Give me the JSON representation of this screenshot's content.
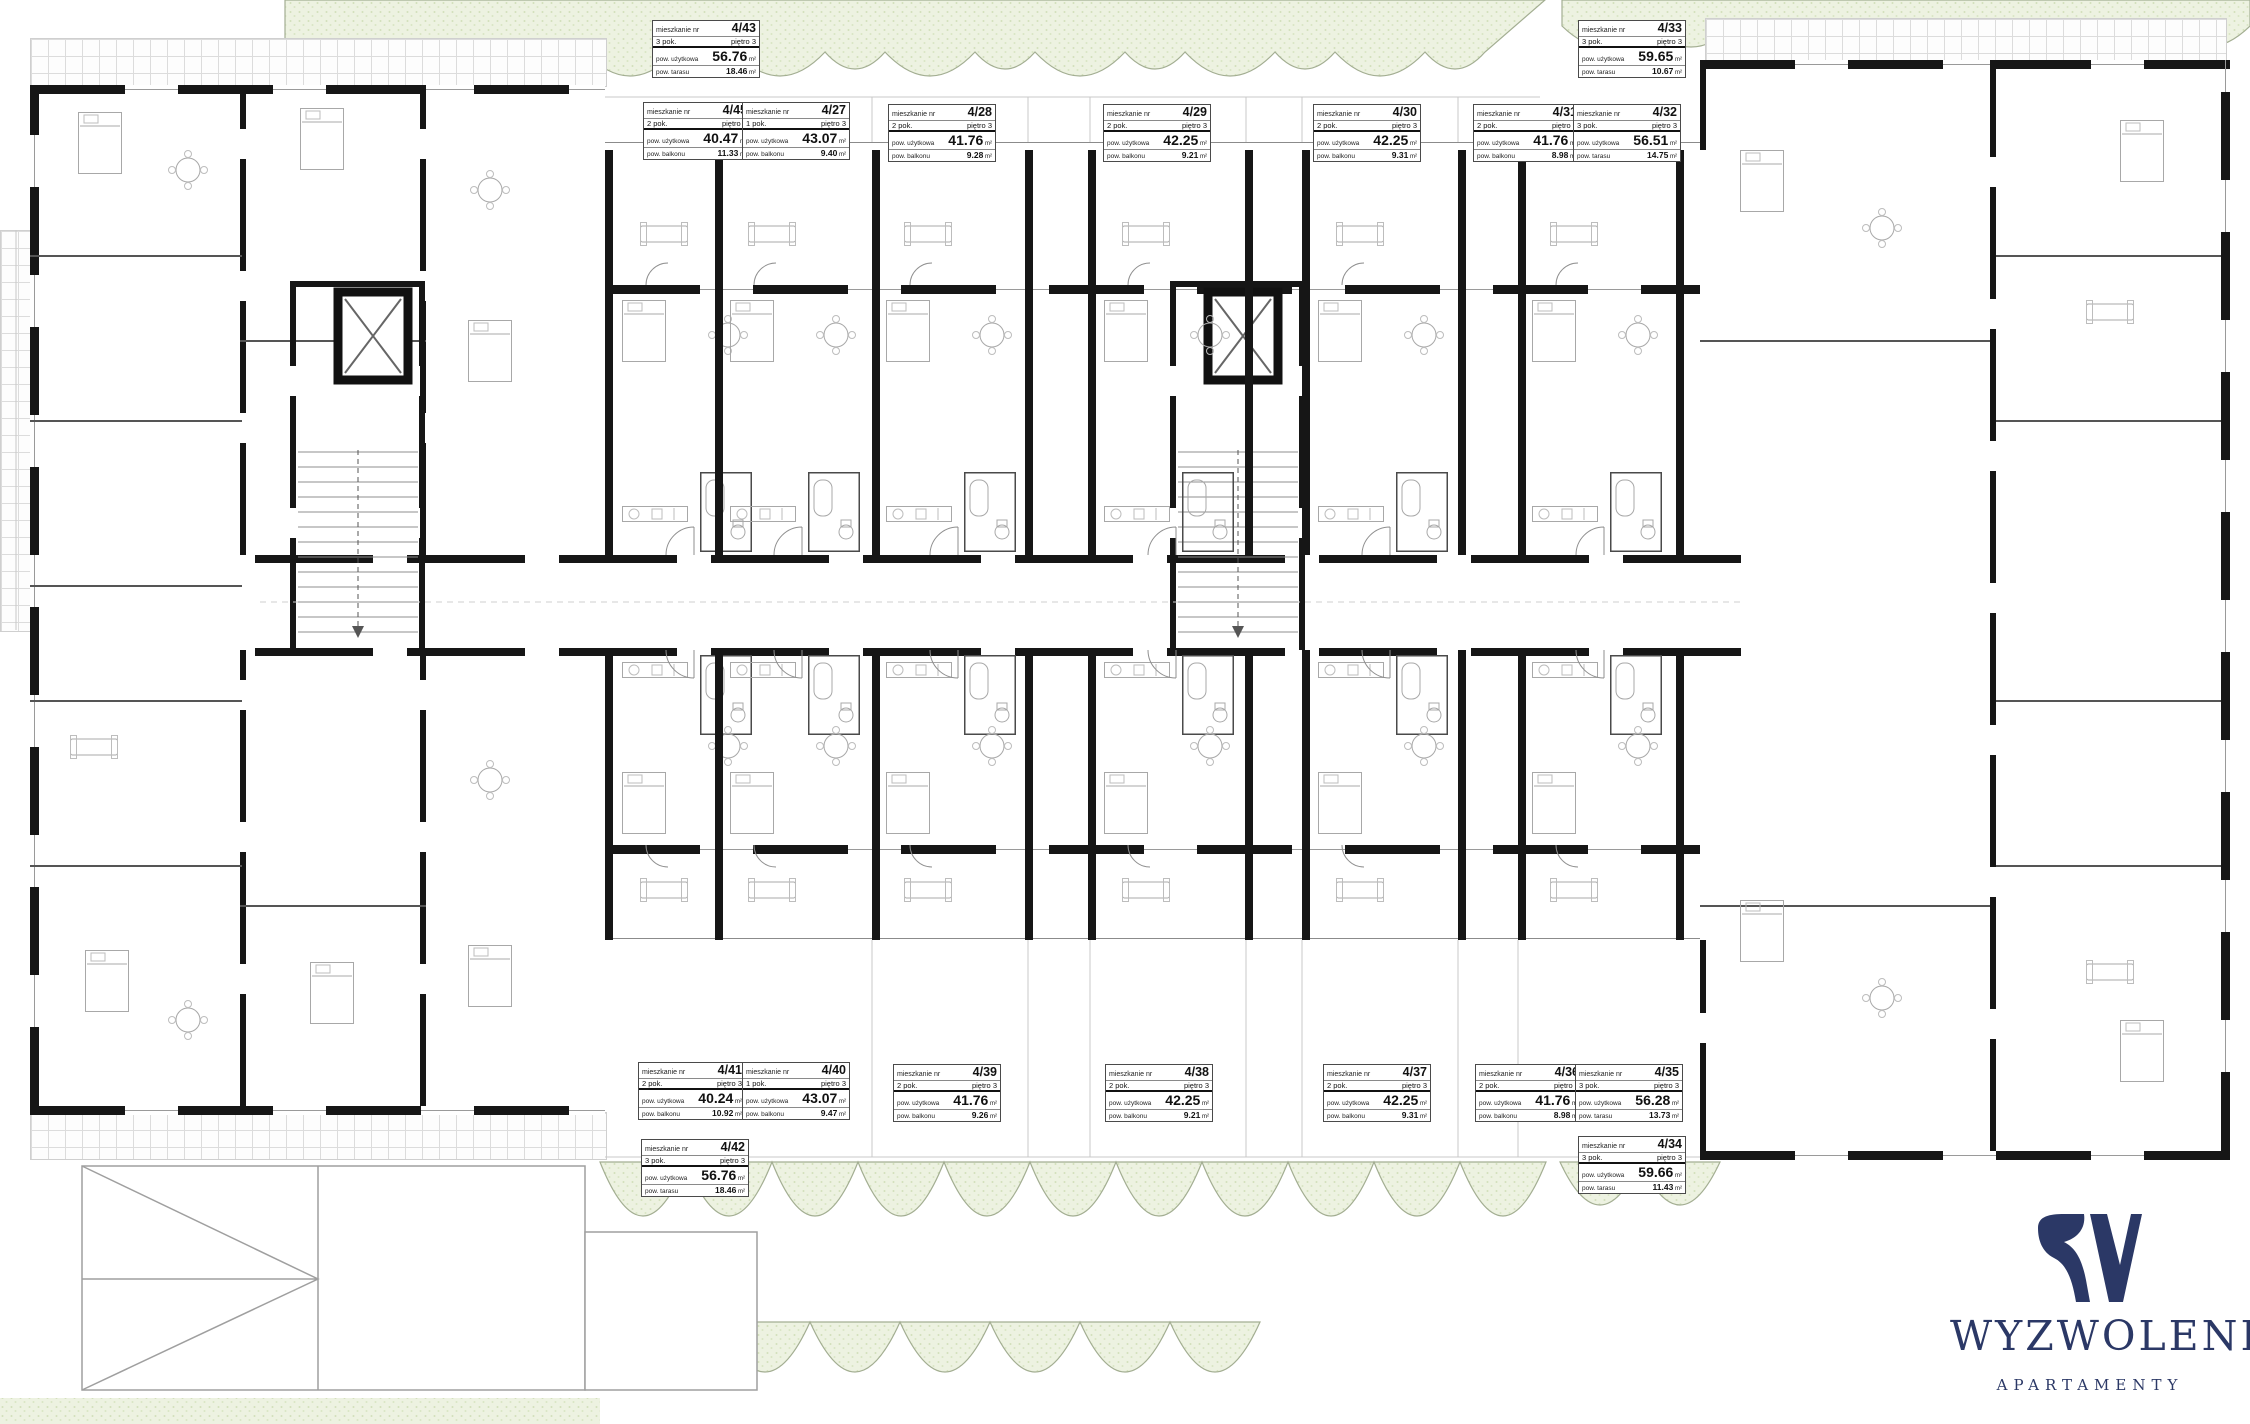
{
  "branding": {
    "name": "WYZWOLENIA",
    "tagline": "APARTAMENTY",
    "monogram": "W",
    "logo_color": "#2b3866"
  },
  "tag_labels": {
    "unit_prefix": "mieszkanie nr",
    "area_label": "pow. użytkowa",
    "balcony_label": "pow. balkonu",
    "terrace_label": "pow. tarasu",
    "floor_label": "piętro 3",
    "m2": "m²"
  },
  "apartments": [
    {
      "number": "4/43",
      "rooms": "3 pok.",
      "floor": "piętro 3",
      "area": "56.76",
      "outdoor_label": "pow. tarasu",
      "outdoor": "18.46"
    },
    {
      "number": "4/45",
      "rooms": "2 pok.",
      "floor": "piętro 3",
      "area": "40.47",
      "outdoor_label": "pow. balkonu",
      "outdoor": "11.33"
    },
    {
      "number": "4/27",
      "rooms": "1 pok.",
      "floor": "piętro 3",
      "area": "43.07",
      "outdoor_label": "pow. balkonu",
      "outdoor": "9.40"
    },
    {
      "number": "4/28",
      "rooms": "2 pok.",
      "floor": "piętro 3",
      "area": "41.76",
      "outdoor_label": "pow. balkonu",
      "outdoor": "9.28"
    },
    {
      "number": "4/29",
      "rooms": "2 pok.",
      "floor": "piętro 3",
      "area": "42.25",
      "outdoor_label": "pow. balkonu",
      "outdoor": "9.21"
    },
    {
      "number": "4/30",
      "rooms": "2 pok.",
      "floor": "piętro 3",
      "area": "42.25",
      "outdoor_label": "pow. balkonu",
      "outdoor": "9.31"
    },
    {
      "number": "4/31",
      "rooms": "2 pok.",
      "floor": "piętro 3",
      "area": "41.76",
      "outdoor_label": "pow. balkonu",
      "outdoor": "8.98"
    },
    {
      "number": "4/32",
      "rooms": "3 pok.",
      "floor": "piętro 3",
      "area": "56.51",
      "outdoor_label": "pow. tarasu",
      "outdoor": "14.75"
    },
    {
      "number": "4/33",
      "rooms": "3 pok.",
      "floor": "piętro 3",
      "area": "59.65",
      "outdoor_label": "pow. tarasu",
      "outdoor": "10.67"
    },
    {
      "number": "4/41",
      "rooms": "2 pok.",
      "floor": "piętro 3",
      "area": "40.24",
      "outdoor_label": "pow. balkonu",
      "outdoor": "10.92"
    },
    {
      "number": "4/40",
      "rooms": "1 pok.",
      "floor": "piętro 3",
      "area": "43.07",
      "outdoor_label": "pow. balkonu",
      "outdoor": "9.47"
    },
    {
      "number": "4/39",
      "rooms": "2 pok.",
      "floor": "piętro 3",
      "area": "41.76",
      "outdoor_label": "pow. balkonu",
      "outdoor": "9.26"
    },
    {
      "number": "4/38",
      "rooms": "2 pok.",
      "floor": "piętro 3",
      "area": "42.25",
      "outdoor_label": "pow. balkonu",
      "outdoor": "9.21"
    },
    {
      "number": "4/37",
      "rooms": "2 pok.",
      "floor": "piętro 3",
      "area": "42.25",
      "outdoor_label": "pow. balkonu",
      "outdoor": "9.31"
    },
    {
      "number": "4/36",
      "rooms": "2 pok.",
      "floor": "piętro 3",
      "area": "41.76",
      "outdoor_label": "pow. balkonu",
      "outdoor": "8.98"
    },
    {
      "number": "4/35",
      "rooms": "3 pok.",
      "floor": "piętro 3",
      "area": "56.28",
      "outdoor_label": "pow. tarasu",
      "outdoor": "13.73"
    },
    {
      "number": "4/34",
      "rooms": "3 pok.",
      "floor": "piętro 3",
      "area": "59.66",
      "outdoor_label": "pow. tarasu",
      "outdoor": "11.43"
    },
    {
      "number": "4/42",
      "rooms": "3 pok.",
      "floor": "piętro 3",
      "area": "56.76",
      "outdoor_label": "pow. tarasu",
      "outdoor": "18.46"
    }
  ],
  "colors": {
    "wall": "#161616",
    "paving_line": "#dcdcdc",
    "green_fill": "#edf2e1",
    "green_stroke": "#a3ae92",
    "navy": "#2b3866"
  }
}
